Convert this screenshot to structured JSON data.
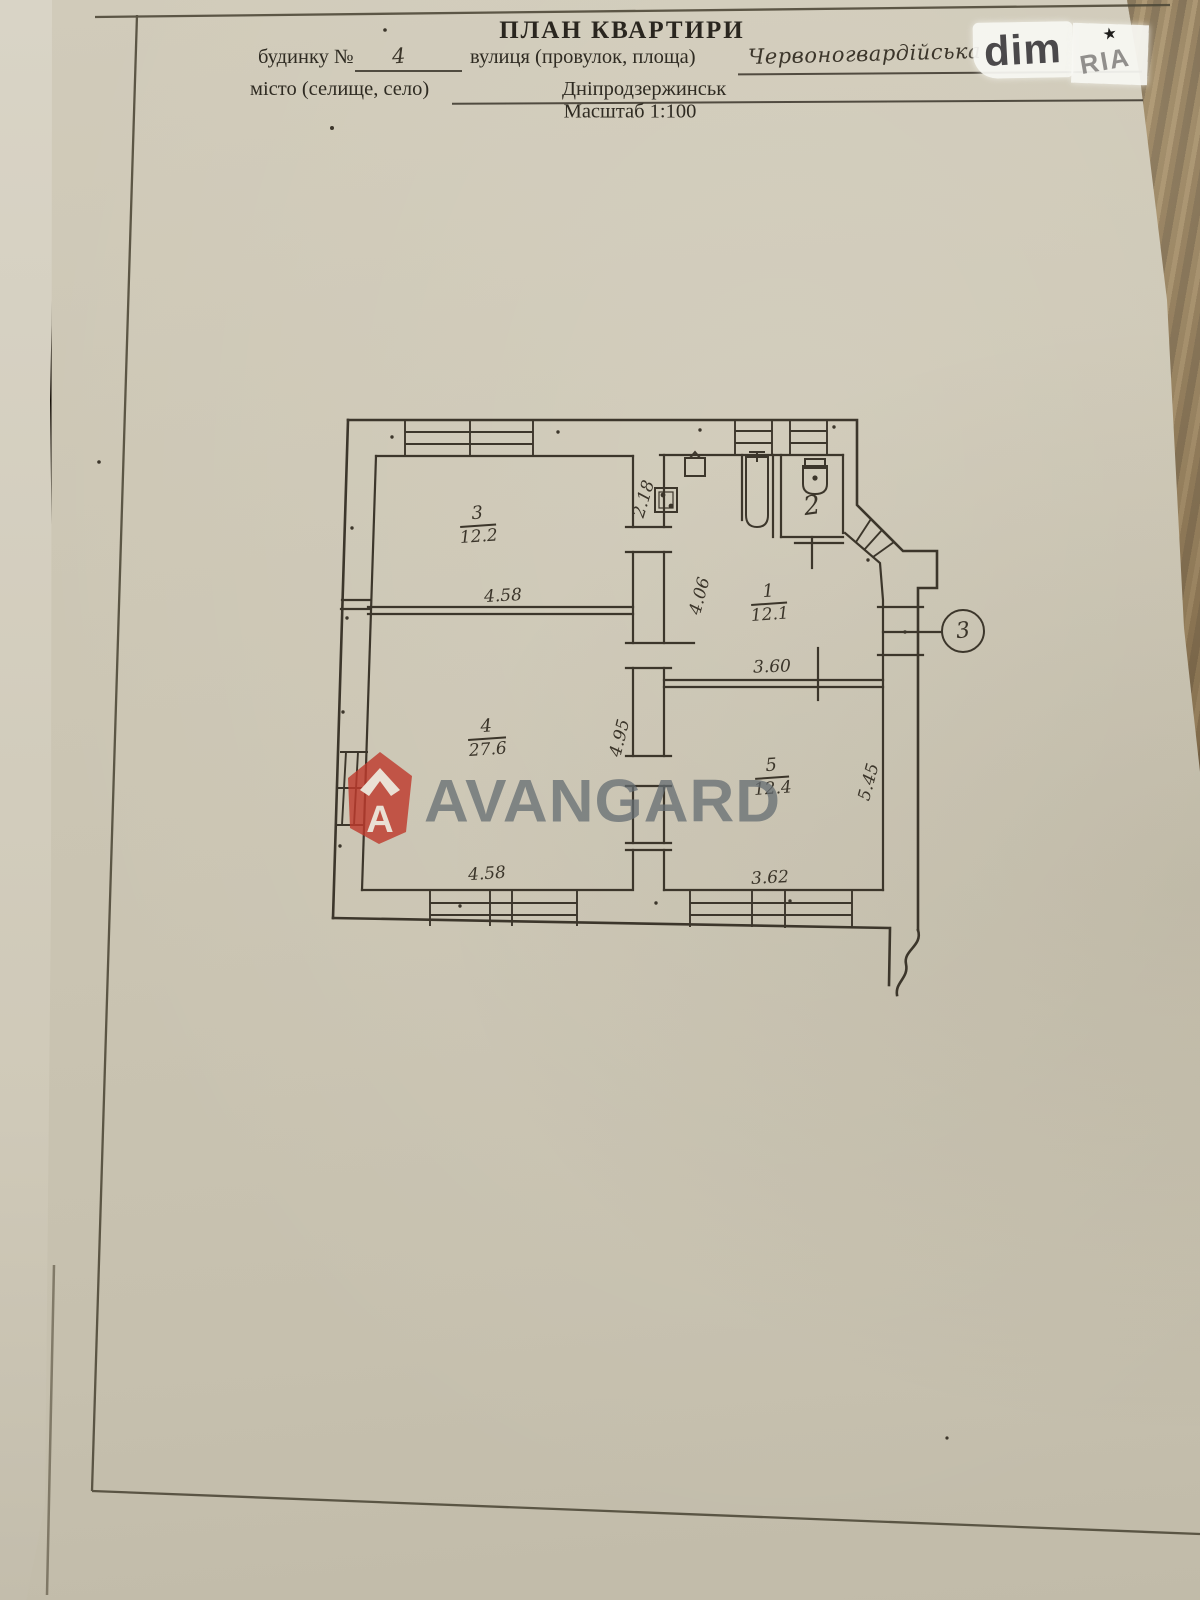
{
  "header": {
    "title": "ПЛАН КВАРТИРИ",
    "house_label": "будинку №",
    "house_number": "4",
    "street_label": "вулиця (провулок, площа)",
    "street_name": "Червоногвардійська",
    "city_label": "місто (селище, село)",
    "city_name": "Дніпродзержинськ",
    "scale": "Масштаб 1:100"
  },
  "badges": {
    "dim": "dim",
    "ria": "RIA",
    "ria_star": "★"
  },
  "watermark": {
    "brand": "AVANGARD",
    "logo_letter": "A"
  },
  "plan": {
    "rooms": [
      {
        "number": "3",
        "area": "12.2"
      },
      {
        "number": "4",
        "area": "27.6"
      },
      {
        "number": "1",
        "area": "12.1"
      },
      {
        "number": "5",
        "area": "12.4"
      },
      {
        "number": "2",
        "area": ""
      }
    ],
    "dims": {
      "w458_top": "4.58",
      "w458_bottom": "4.58",
      "d218": "2.18",
      "d406": "4.06",
      "d495": "4.95",
      "d360": "3.60",
      "d362": "3.62",
      "d545": "5.45"
    },
    "entrance_mark": "3"
  }
}
